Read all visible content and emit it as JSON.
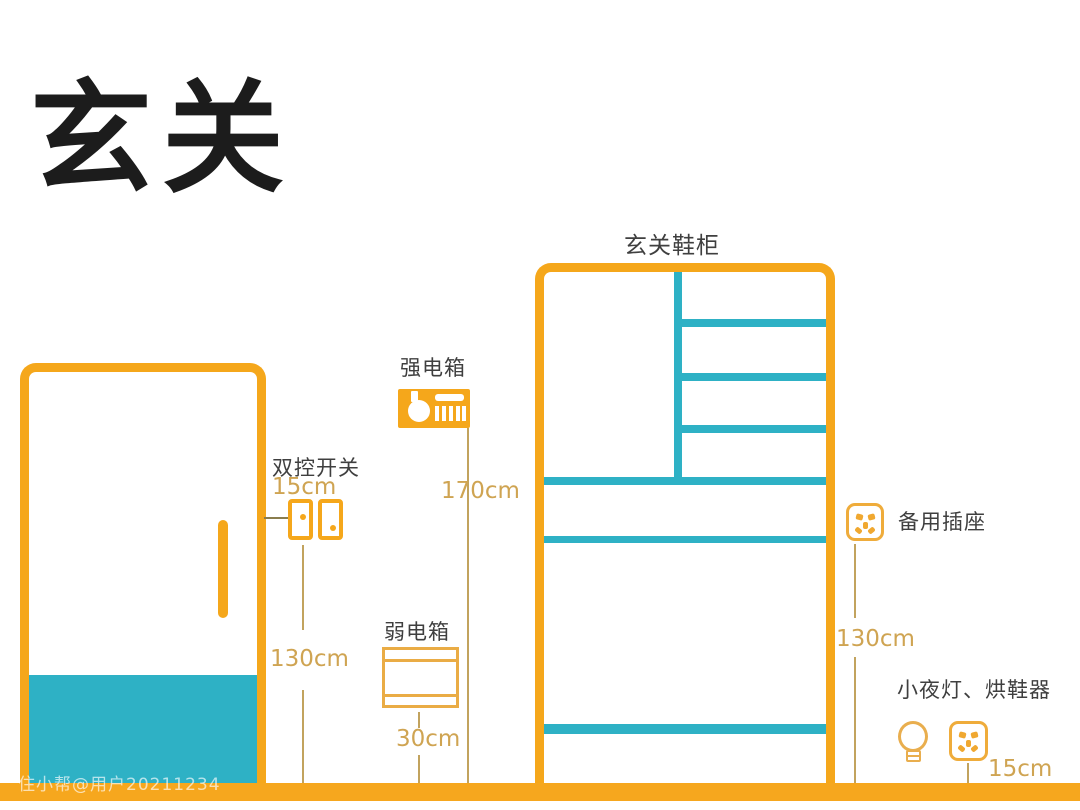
{
  "page": {
    "title": "玄关",
    "watermark": "住小帮@用户20211234"
  },
  "colors": {
    "accent_orange": "#F5A71B",
    "shelf_teal": "#2EB1C5",
    "measure_gold": "#CFA452",
    "label_gray": "#3F3F3F",
    "floor_orange": "#F6A71E"
  },
  "icons": {
    "door": "door-icon",
    "door_handle": "door-handle-icon",
    "switch": "double-switch-icon",
    "strong_box": "breaker-panel-icon",
    "weak_box": "network-box-icon",
    "spare_socket": "power-socket-icon",
    "night_socket": "power-socket-icon",
    "bulb": "light-bulb-icon"
  },
  "annotations": {
    "switch": {
      "label": "双控开关",
      "offset": "15cm",
      "height": "130cm"
    },
    "strong_box": {
      "label": "强电箱",
      "height": "170cm"
    },
    "weak_box": {
      "label": "弱电箱",
      "height": "30cm"
    },
    "cabinet": {
      "label": "玄关鞋柜"
    },
    "spare_socket": {
      "label": "备用插座",
      "height": "130cm"
    },
    "night_light": {
      "label": "小夜灯、烘鞋器",
      "height": "15cm"
    }
  }
}
